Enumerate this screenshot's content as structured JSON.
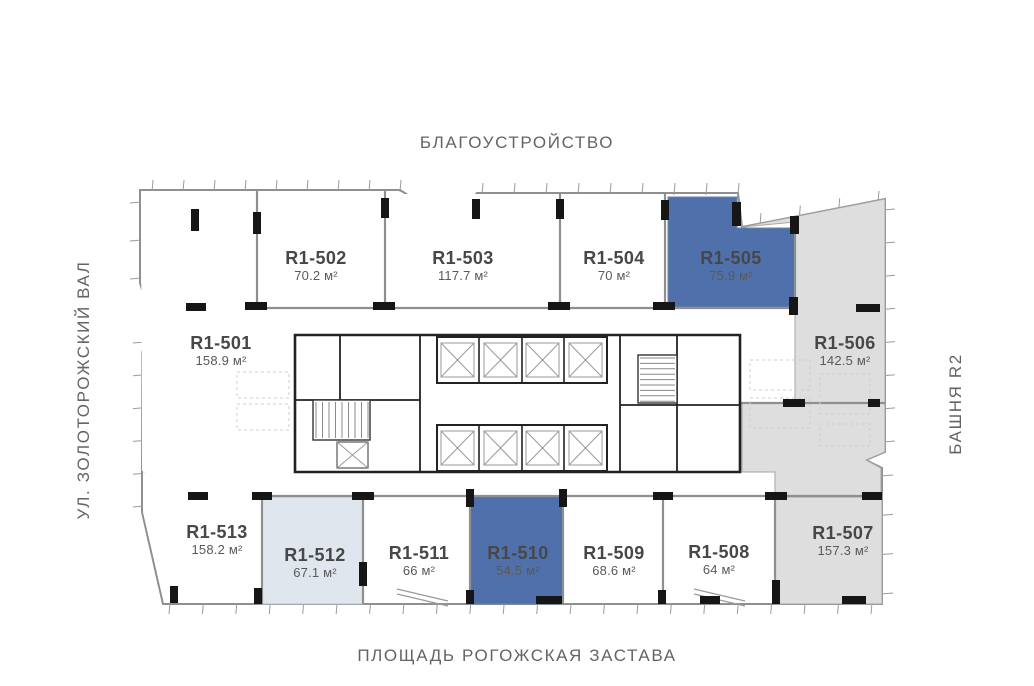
{
  "surroundings": {
    "top": "БЛАГОУСТРОЙСТВО",
    "left": "УЛ. ЗОЛОТОРОЖСКИЙ ВАЛ",
    "right": "БАШНЯ R2",
    "bottom": "ПЛОЩАДЬ РОГОЖСКАЯ ЗАСТАВА"
  },
  "colors": {
    "unit_selected": "#5070ac",
    "unit_light": "#e0e6ee",
    "unit_muted": "#dedede",
    "outline": "#8f8f8f",
    "column": "#161616",
    "core": "#222222",
    "title_text": "#474747",
    "area_text": "#595959",
    "street_text": "#646464"
  },
  "units": [
    {
      "id": "R1-501",
      "area": "158.9 м²",
      "fill": "white"
    },
    {
      "id": "R1-502",
      "area": "70.2 м²",
      "fill": "white"
    },
    {
      "id": "R1-503",
      "area": "117.7 м²",
      "fill": "white"
    },
    {
      "id": "R1-504",
      "area": "70 м²",
      "fill": "white"
    },
    {
      "id": "R1-505",
      "area": "75.9 м²",
      "fill": "blue"
    },
    {
      "id": "R1-506",
      "area": "142.5 м²",
      "fill": "gray"
    },
    {
      "id": "R1-507",
      "area": "157.3 м²",
      "fill": "gray"
    },
    {
      "id": "R1-508",
      "area": "64 м²",
      "fill": "white"
    },
    {
      "id": "R1-509",
      "area": "68.6 м²",
      "fill": "white"
    },
    {
      "id": "R1-510",
      "area": "54.5 м²",
      "fill": "blue"
    },
    {
      "id": "R1-511",
      "area": "66 м²",
      "fill": "white"
    },
    {
      "id": "R1-512",
      "area": "67.1 м²",
      "fill": "pale"
    },
    {
      "id": "R1-513",
      "area": "158.2 м²",
      "fill": "white"
    }
  ]
}
